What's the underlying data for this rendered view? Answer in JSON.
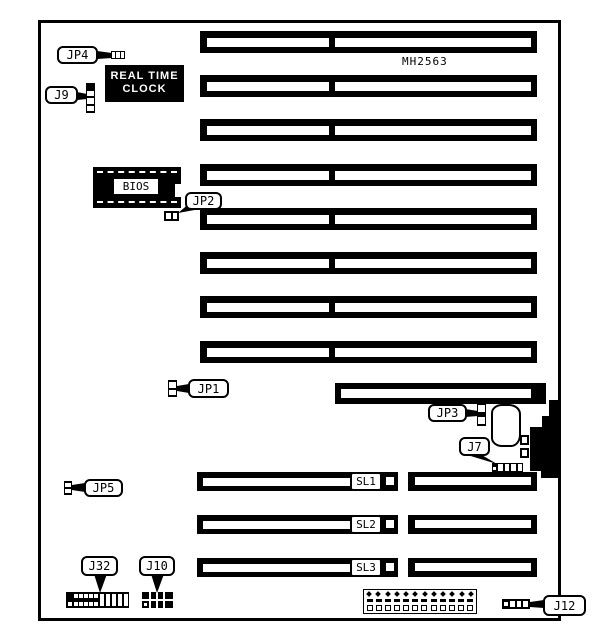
{
  "board": {
    "model_number": "MH2563",
    "colors": {
      "ink": "#000000",
      "paper": "#ffffff"
    },
    "chips": {
      "rtc_line1": "REAL TIME",
      "rtc_line2": "CLOCK",
      "bios": "BIOS"
    },
    "callouts": {
      "jp4": "JP4",
      "j9": "J9",
      "jp2": "JP2",
      "jp1": "JP1",
      "jp3": "JP3",
      "j7": "J7",
      "jp5": "JP5",
      "j32": "J32",
      "j10": "J10",
      "j12": "J12"
    },
    "slots": {
      "sl1": "SL1",
      "sl2": "SL2",
      "sl3": "SL3"
    }
  }
}
